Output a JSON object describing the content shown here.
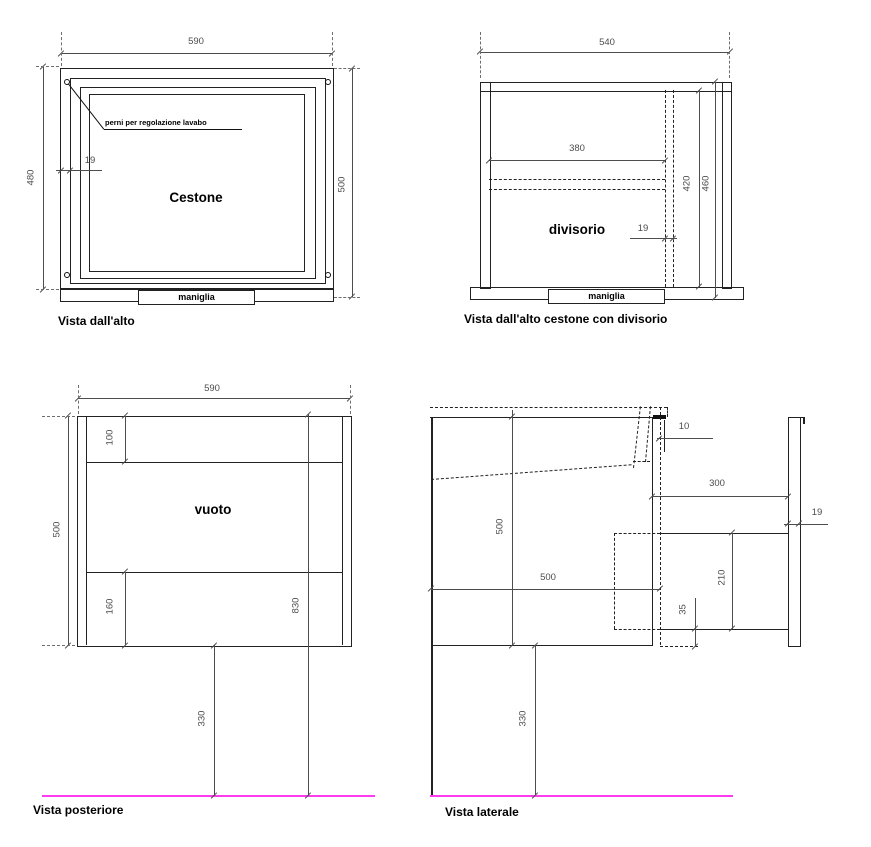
{
  "drawing": {
    "colors": {
      "line": "#222222",
      "dimension": "#4d4d4d",
      "floor": "#ff3bf0"
    },
    "views": {
      "top": {
        "title": "Vista dall'alto",
        "label": "Cestone",
        "handle_label": "maniglia",
        "annotation": "perni per regolazione lavabo",
        "dims": {
          "width": "590",
          "height_left": "480",
          "height_right": "500",
          "frame_thickness": "19"
        }
      },
      "top_divider": {
        "title": "Vista dall'alto cestone con divisorio",
        "label": "divisorio",
        "handle_label": "maniglia",
        "dims": {
          "width": "540",
          "inner_width": "380",
          "depth_inner": "420",
          "depth_outer": "460",
          "divider_thickness": "19"
        }
      },
      "rear": {
        "title": "Vista posteriore",
        "label": "vuoto",
        "dims": {
          "width": "590",
          "height": "500",
          "top_rail": "100",
          "bottom_rail": "160",
          "total_height": "830",
          "floor_gap": "330"
        }
      },
      "side": {
        "title": "Vista laterale",
        "dims": {
          "height": "500",
          "depth": "500",
          "shelf_length": "300",
          "panel_thickness": "19",
          "front_gap": "10",
          "bracket_height": "210",
          "offset": "35",
          "floor_gap": "330"
        }
      }
    }
  }
}
